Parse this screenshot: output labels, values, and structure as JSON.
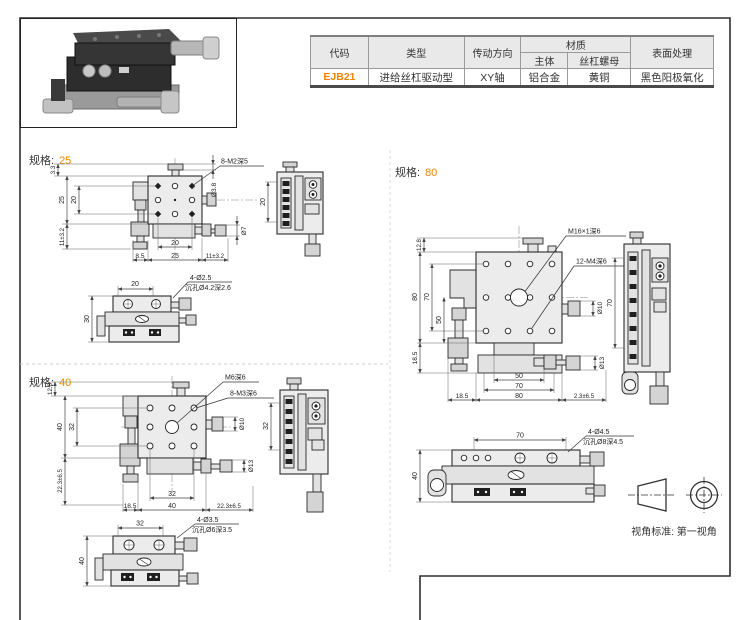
{
  "accent_color": "#f08300",
  "table": {
    "headers": {
      "code": "代码",
      "type": "类型",
      "direction": "传动方向",
      "material": "材质",
      "material_body": "主体",
      "material_nut": "丝杠螺母",
      "surface": "表面处理"
    },
    "row": {
      "code": "EJB21",
      "type": "进给丝杠驱动型",
      "direction": "XY轴",
      "material_body": "铝合金",
      "material_nut": "黄铜",
      "surface": "黑色阳极氧化"
    }
  },
  "specs": [
    {
      "label": "规格:",
      "size": "25",
      "plan": {
        "thread_note": "8-M2深5",
        "dim_top_offset": "3.3",
        "dim_body_v": "25",
        "dim_holes_v": "20",
        "dim_travel_v": "11±3.2",
        "dim_holes_h": "20",
        "dim_left_offset": "8.5",
        "dim_body_h": "25",
        "dim_travel_h": "11±3.2",
        "dia_top": "Ø3.8",
        "dia_knob_y": "Ø7"
      },
      "side": {
        "dim": "20"
      },
      "front": {
        "dim_top": "20",
        "dim_height": "30",
        "note1": "4-Ø2.5",
        "note2": "沉孔Ø4.2深2.6"
      }
    },
    {
      "label": "规格:",
      "size": "40",
      "plan": {
        "center_note": "M6深6",
        "thread_note": "8-M3深6",
        "dim_top_offset": "12.8",
        "dim_body_v": "40",
        "dim_holes_v": "32",
        "dim_travel_v": "22.3±6.5",
        "dim_holes_h": "32",
        "dim_left_offset": "18.5",
        "dim_body_h": "40",
        "dim_travel_h": "22.3±6.5",
        "dia_knob_x": "Ø10",
        "dia_knob_y": "Ø13"
      },
      "side": {
        "dim": "32"
      },
      "front": {
        "dim_top": "32",
        "dim_height": "40",
        "note1": "4-Ø3.5",
        "note2": "沉孔Ø6深3.5"
      }
    },
    {
      "label": "规格:",
      "size": "80",
      "plan": {
        "center_note": "M16×1深6",
        "thread_note": "12-M4深6",
        "dim_top_offset": "12.8",
        "dim_body_v": "80",
        "dim_holes_v": "70",
        "dim_inner_v": "50",
        "dim_base_v": "18.5",
        "dim_inner_h": "50",
        "dim_mid_h": "70",
        "dim_body_h": "80",
        "dim_left_offset": "18.5",
        "dim_travel_h": "2.3±6.5",
        "dia_knob_x": "Ø10",
        "dia_knob_y": "Ø13"
      },
      "side": {
        "dim": "70"
      },
      "front": {
        "dim_top": "70",
        "dim_height": "40",
        "note1": "4-Ø4.5",
        "note2": "沉孔Ø8深4.5"
      }
    }
  ],
  "projection": {
    "label": "视角标准: 第一视角"
  }
}
